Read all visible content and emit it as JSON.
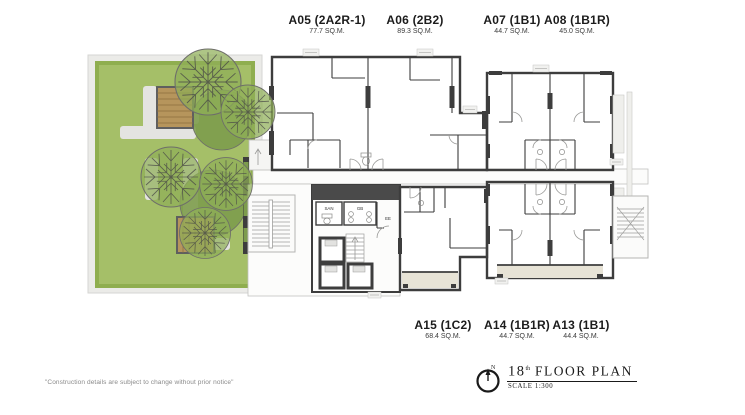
{
  "units_top": [
    {
      "name": "A05 (2A2R-1)",
      "area": "77.7 SQ.M."
    },
    {
      "name": "A06 (2B2)",
      "area": "89.3 SQ.M."
    },
    {
      "name": "A07 (1B1)",
      "area": "44.7 SQ.M."
    },
    {
      "name": "A08 (1B1R)",
      "area": "45.0 SQ.M."
    }
  ],
  "units_bottom": [
    {
      "name": "A15 (1C2)",
      "area": "68.4 SQ.M."
    },
    {
      "name": "A14 (1B1R)",
      "area": "44.7 SQ.M."
    },
    {
      "name": "A13 (1B1)",
      "area": "44.4 SQ.M."
    }
  ],
  "core_labels": {
    "san": "SAN",
    "gb": "GB",
    "ee": "EE"
  },
  "legend": {
    "floor_number": "18",
    "floor_suffix": "th",
    "plan_title": "FLOOR PLAN",
    "scale": "SCALE 1:300",
    "compass_n": "N"
  },
  "disclaimer": "\"Construction details are subject to change without prior notice\"",
  "colors": {
    "unit_tan": "#cfc19b",
    "unit_beige": "#e2ddd0",
    "balcony": "#e7e3d6",
    "wall": "#3d3d3d",
    "core_band": "#4a4a4a",
    "lawn": "#a5bf68",
    "lawn_border": "#8fae4f",
    "shrub": "#7d9c4d",
    "tree": "#8fae57",
    "deck": "#b6955c",
    "path": "#e4e4e1"
  }
}
